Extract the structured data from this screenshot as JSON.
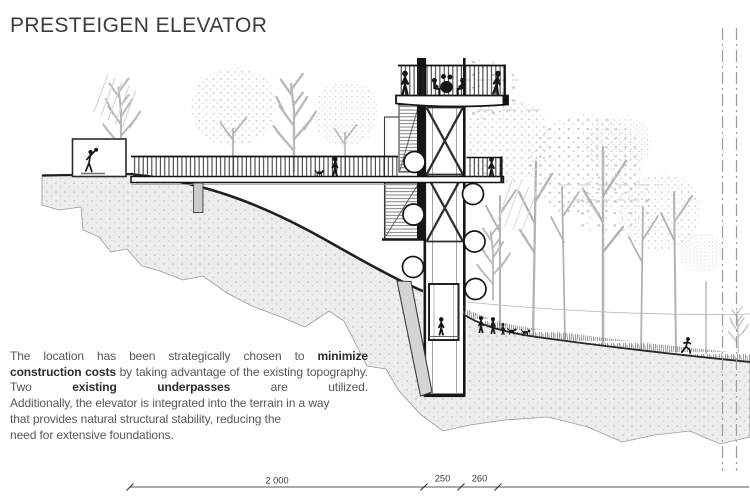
{
  "page": {
    "title": "PRESTEIGEN ELEVATOR",
    "background_color": "#ffffff"
  },
  "description": {
    "justified_part": [
      {
        "text": "The location has been strategically chosen to ",
        "bold": false
      },
      {
        "text": "minimize construction costs",
        "bold": true
      },
      {
        "text": " by taking advantage of the existing topography. Two ",
        "bold": false
      },
      {
        "text": "existing underpasses",
        "bold": true
      },
      {
        "text": " are utilized.",
        "bold": false
      }
    ],
    "left_part": [
      {
        "text": "Additionally, the elevator is integrated into the terrain in a way",
        "bold": false,
        "br": true
      },
      {
        "text": "that provides natural structural stability, reducing the",
        "bold": false,
        "br": true
      },
      {
        "text": "need for extensive foundations.",
        "bold": false,
        "br": false
      }
    ]
  },
  "dimensions": {
    "labels": [
      "2 000",
      "250",
      "260"
    ]
  },
  "drawing": {
    "type": "architectural-section",
    "colors": {
      "linework": "#161616",
      "terrain_fill": "#ededed",
      "vegetation": "#bdbdbd",
      "dimension_line": "#565656"
    }
  }
}
